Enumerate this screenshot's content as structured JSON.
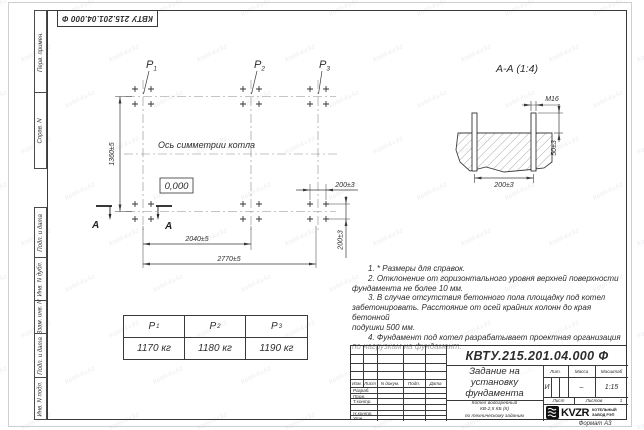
{
  "colors": {
    "ink": "#3a3a3a",
    "frame": "#3a3a3a",
    "sheet_edge": "#cfcfcf"
  },
  "watermark": {
    "text": "kotel-kv.kz"
  },
  "stamp_top": "КВТУ 215.201.04.000 Ф",
  "margin_labels": {
    "top": [
      "Перв. примен.",
      "Справ. N"
    ],
    "bottom": [
      "Подп. и дата",
      "Инв. N дубл.",
      "Взам. инв. N",
      "Подп. и дата",
      "Инв. N подл."
    ]
  },
  "plan": {
    "axis_label": "Ось симметрии котла",
    "level_mark": "0,000",
    "section_letter": "A",
    "points": [
      {
        "symbol": "P",
        "sub": "1"
      },
      {
        "symbol": "P",
        "sub": "2"
      },
      {
        "symbol": "P",
        "sub": "3"
      }
    ],
    "dims": {
      "height": "1360±5",
      "span_mid": "2040±5",
      "span_full": "2770±5",
      "bolt_x": "200±3",
      "bolt_y": "200±3"
    }
  },
  "section": {
    "title": "А-А (1:4)",
    "thread": "М16",
    "protrusion": "50±3",
    "spacing": "200±3"
  },
  "notes": {
    "lines": [
      "1. * Размеры для справок.",
      "2. Отклонение от горизонтального уровня верхней поверхности",
      "фундамента не более 10 мм.",
      "3. В случае отсутствия бетонного пола площадку под котел",
      "забетонировать. Расстояние от осей крайних колонн до края бетонной",
      "подушки 500 мм.",
      "4. Фундамент под котел разрабатывает проектная организация",
      "по нагрузкам на фундамент."
    ]
  },
  "loads": {
    "columns": [
      {
        "symbol": "P",
        "sub": "1",
        "value": "1170 кг"
      },
      {
        "symbol": "P",
        "sub": "2",
        "value": "1180 кг"
      },
      {
        "symbol": "P",
        "sub": "3",
        "value": "1190 кг"
      }
    ]
  },
  "titleblock": {
    "doc_number": "КВТУ.215.201.04.000 Ф",
    "title_lines": [
      "Задание на",
      "установку",
      "фундамента"
    ],
    "subtitle_lines": [
      "Котел водогрейный",
      "КВ-2,5 КБ (К)",
      "по техническому заданию"
    ],
    "header_cols": [
      "Изм.",
      "Лист",
      "N докум.",
      "Подп.",
      "Дата"
    ],
    "rows": [
      "Разраб.",
      "Пров.",
      "Т.контр.",
      "",
      "Н.контр.",
      "Утв."
    ],
    "lit_label": "Лит.",
    "lit_value": "И",
    "mass_label": "Масса",
    "mass_value": "–",
    "scale_label": "Масштаб",
    "scale_value": "1:15",
    "sheet_label": "Лист",
    "sheets_label": "Листов",
    "sheets_value": "1",
    "logo_text": "KVZR",
    "logo_caption_lines": [
      "КОТЕЛЬНЫЙ",
      "ЗАВОД РЭП"
    ],
    "format_label": "Формат А3"
  }
}
